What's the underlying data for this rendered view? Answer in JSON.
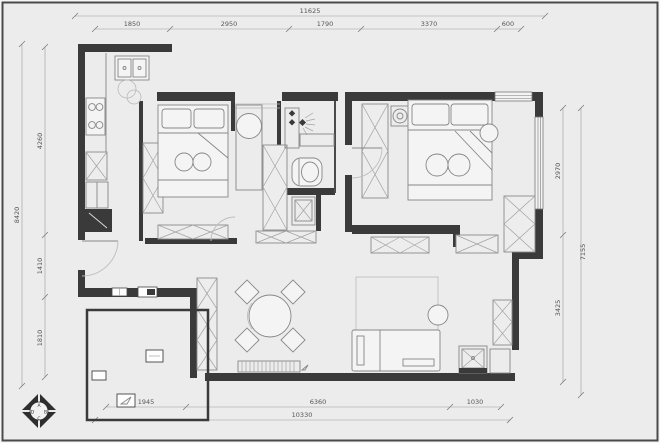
{
  "plan": {
    "background_color": "#ececec",
    "wall_color": "#3a3a3a",
    "furniture_line_color": "#878787",
    "dimension_line_color": "#9a9a9a",
    "dimension_text_color": "#555555",
    "dimensions": {
      "top": {
        "total": "11625",
        "segments": [
          "1850",
          "2950",
          "1790",
          "3370",
          "600"
        ]
      },
      "left": {
        "total": "8420",
        "segments": [
          "4260",
          "1410",
          "1810"
        ]
      },
      "right": {
        "total": "7155",
        "segments": [
          "2970",
          "3425"
        ]
      },
      "bottom": {
        "total": "10330",
        "segments": [
          "1945",
          "6360",
          "1030"
        ]
      }
    },
    "compass": {
      "letters": [
        "A",
        "B",
        "C",
        "D"
      ]
    },
    "fixtures": [
      "kitchen-sink",
      "cooktop",
      "refrigerator",
      "base-cabinet",
      "single-bed",
      "double-bed",
      "wardrobe",
      "washbasin",
      "vanity",
      "shower-head",
      "toilet",
      "washing-machine",
      "dining-table",
      "dining-chair",
      "sofa",
      "side-table",
      "tv-bench",
      "rug",
      "door-swing",
      "window",
      "power-outlet",
      "compass-rose"
    ]
  }
}
